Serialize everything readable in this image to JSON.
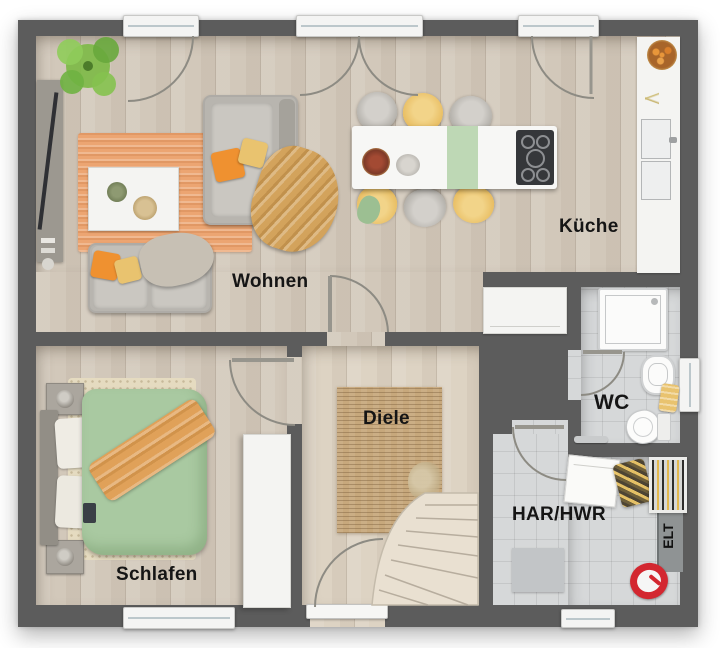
{
  "plan": {
    "rooms": [
      {
        "id": "wohnen",
        "label": "Wohnen"
      },
      {
        "id": "kueche",
        "label": "Küche"
      },
      {
        "id": "schlafen",
        "label": "Schlafen"
      },
      {
        "id": "diele",
        "label": "Diele"
      },
      {
        "id": "wc",
        "label": "WC"
      },
      {
        "id": "har_hwr",
        "label": "HAR/HWR"
      },
      {
        "id": "elt",
        "label": "ELT"
      }
    ]
  },
  "colors": {
    "wall": "#5c5c5c",
    "wood_floor": "#d2c8ba",
    "hall_floor": "#ddd3c3",
    "tile_floor": "#d6d8d9",
    "rug_living": "#eca572",
    "rug_hall": "#c7a87c",
    "duvet_green": "#a9c9a1",
    "accent_orange": "#ef9130",
    "accent_yellow": "#e9c36f",
    "accent_green": "#b7d4ae",
    "stairs": "#e9e0d1",
    "plant_green": "#7cb945",
    "red_item": "#d32730"
  }
}
